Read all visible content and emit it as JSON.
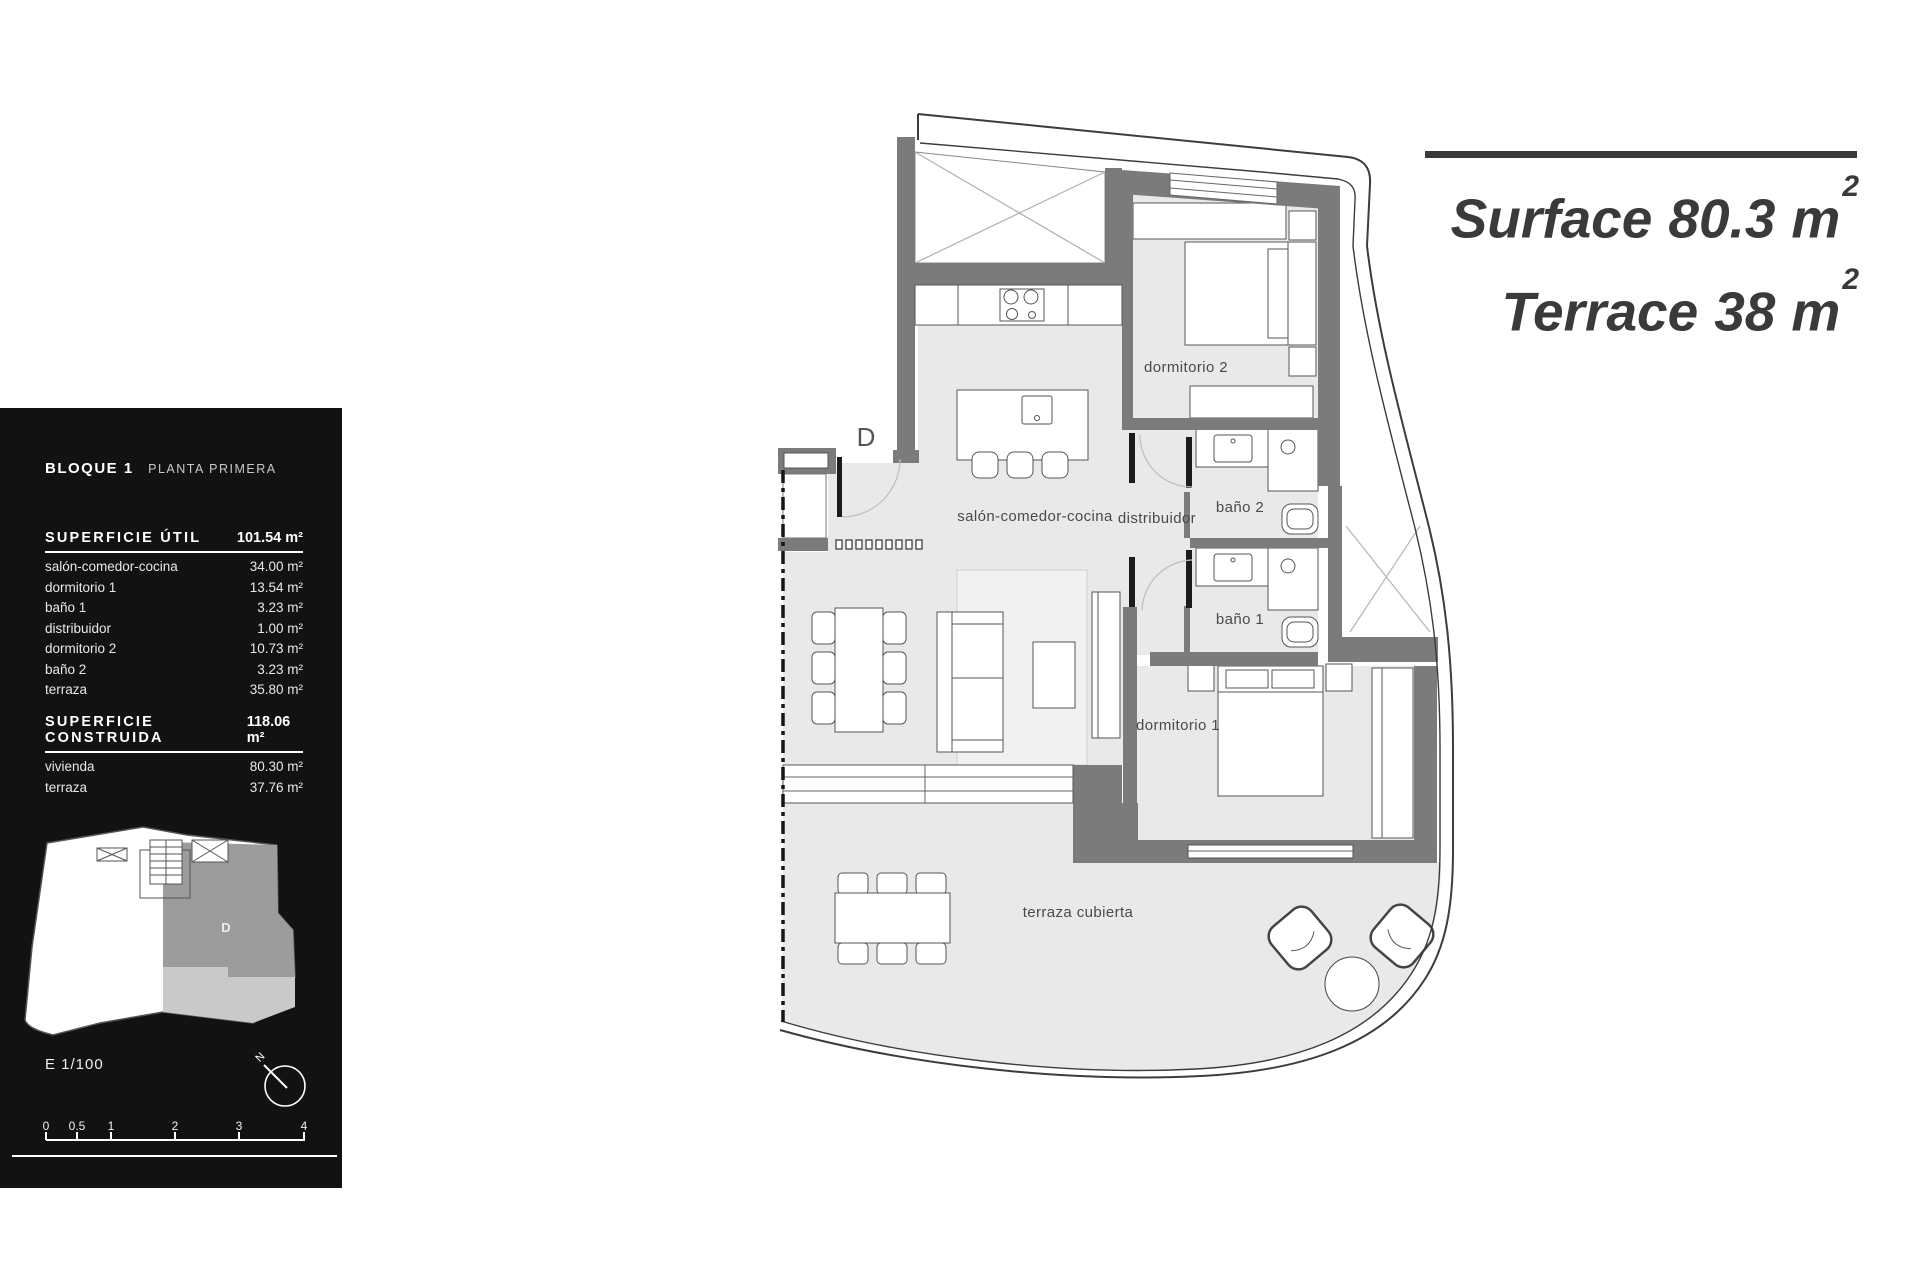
{
  "colors": {
    "panel": "#121212",
    "wall": "#7b7b7b",
    "floor": "#e9e9e9",
    "floorlight": "#f1f1f1",
    "line": "#3c3c3c",
    "titletext": "#3a3a3a",
    "labeltext": "#4a4a4a",
    "kpunit": "#9c9c9c",
    "kpterrace": "#c9c9c9"
  },
  "sidebar": {
    "block_title": "BLOQUE 1",
    "block_subtitle": "PLANTA PRIMERA",
    "util": {
      "label": "SUPERFICIE ÚTIL",
      "value": "101.54 m²",
      "rows": [
        {
          "label": "salón-comedor-cocina",
          "value": "34.00 m²"
        },
        {
          "label": "dormitorio 1",
          "value": "13.54 m²"
        },
        {
          "label": "baño 1",
          "value": "3.23 m²"
        },
        {
          "label": "distribuidor",
          "value": "1.00 m²"
        },
        {
          "label": "dormitorio 2",
          "value": "10.73 m²"
        },
        {
          "label": "baño 2",
          "value": "3.23 m²"
        },
        {
          "label": "terraza",
          "value": "35.80 m²"
        }
      ]
    },
    "construida": {
      "label": "SUPERFICIE CONSTRUIDA",
      "value": "118.06 m²",
      "rows": [
        {
          "label": "vivienda",
          "value": "80.30 m²"
        },
        {
          "label": "terraza",
          "value": "37.76 m²"
        }
      ]
    },
    "keyplan_unit_label": "D",
    "scale_label": "E 1/100",
    "north_label": "N",
    "scale_ticks": [
      "0",
      "0.5",
      "1",
      "2",
      "3",
      "4"
    ]
  },
  "title": {
    "line1_label": "Surface",
    "line1_value": "80.3",
    "line2_label": "Terrace",
    "line2_value": "38",
    "unit": "m",
    "sup": "2"
  },
  "plan": {
    "unit_label": "D",
    "labels": {
      "salon": "salón-comedor-cocina",
      "distribuidor": "distribuidor",
      "bano2": "baño 2",
      "bano1": "baño 1",
      "dormitorio2": "dormitorio 2",
      "dormitorio1": "dormitorio 1",
      "terraza": "terraza cubierta"
    }
  }
}
